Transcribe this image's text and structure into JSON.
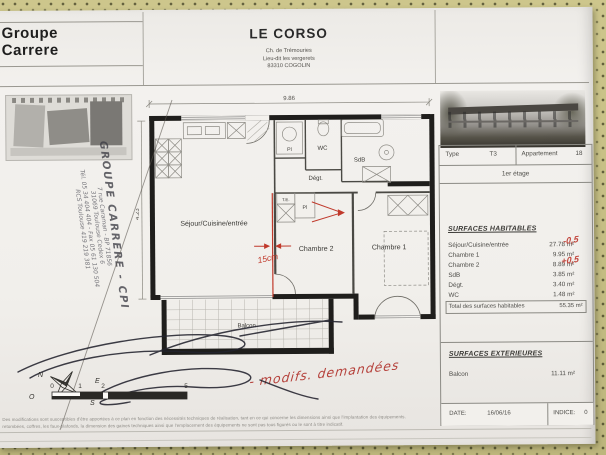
{
  "header": {
    "company_line1": "Groupe",
    "company_line2": "Carrere",
    "project_title": "LE CORSO",
    "address_line1": "Ch. de Trémouries",
    "address_line2": "Lieu-dit les vergerets",
    "address_line3": "83310 COGOLIN"
  },
  "panel": {
    "type_label": "Type",
    "type_value": "T3",
    "apartment_label": "Appartement",
    "apartment_value": "18",
    "floor": "1er étage",
    "surfaces_habitables": {
      "title": "SURFACES HABITABLES",
      "rows": [
        {
          "label": "Séjour/Cuisine/entrée",
          "value": "27.78 m²",
          "note": "-0,5"
        },
        {
          "label": "Chambre 1",
          "value": "9.95 m²",
          "note": ""
        },
        {
          "label": "Chambre 2",
          "value": "8.89 m²",
          "note": "+0,5"
        },
        {
          "label": "SdB",
          "value": "3.85 m²",
          "note": ""
        },
        {
          "label": "Dégt.",
          "value": "3.40 m²",
          "note": ""
        },
        {
          "label": "WC",
          "value": "1.48 m²",
          "note": ""
        }
      ],
      "total_label": "Total des surfaces habitables",
      "total_value": "55.35 m²"
    },
    "surfaces_exterieures": {
      "title": "SURFACES EXTERIEURES",
      "balcon_label": "Balcon",
      "balcon_value": "11.11 m²"
    },
    "date_label": "DATE:",
    "date_value": "16/06/16",
    "indice_label": "INDICE:",
    "indice_value": "0"
  },
  "plan": {
    "rooms": {
      "sejour": "Séjour/Cuisine/entrée",
      "chambre2": "Chambre 2",
      "chambre1": "Chambre 1",
      "wc": "WC",
      "sdb": "SdB",
      "degt": "Dégt.",
      "pl_top": "Pl",
      "pl_ch2": "Pl",
      "te": "T.E.",
      "balcon": "Balcon"
    },
    "dim_width": "9.86",
    "dim_height": "4.23",
    "annotations": {
      "wall_shift": "15cm",
      "request_note": "- modifs. demandées"
    }
  },
  "stamp": {
    "line1": "GROUPE CARRERE - CPI",
    "line2": "7 rue Caraman - BP 71856",
    "line3": "31069 Toulouse Cedex 6",
    "line4": "Tél. 05 34 404 404 - Fax 05 61 130 504",
    "line5": "RCS Toulouse 419 219 381"
  },
  "compass": {
    "n": "N",
    "e": "E",
    "s": "S",
    "o": "O"
  },
  "scalebar": {
    "t0": "0",
    "t1": "1",
    "t2": "2",
    "t5": "5"
  },
  "footer": {
    "line1": "Des modifications sont susceptibles d'être apportées à ce plan en fonction des nécessités techniques de réalisation, tant en ce qui concerne les dimensions ainsi que l'implantation des équipements.",
    "line2": "retombées, coffres, les faux-plafonds, la dimension des gaines techniques ainsi que l'emplacement des équipements ne sont pas tous figurés ou le sont à titre indicatif."
  }
}
